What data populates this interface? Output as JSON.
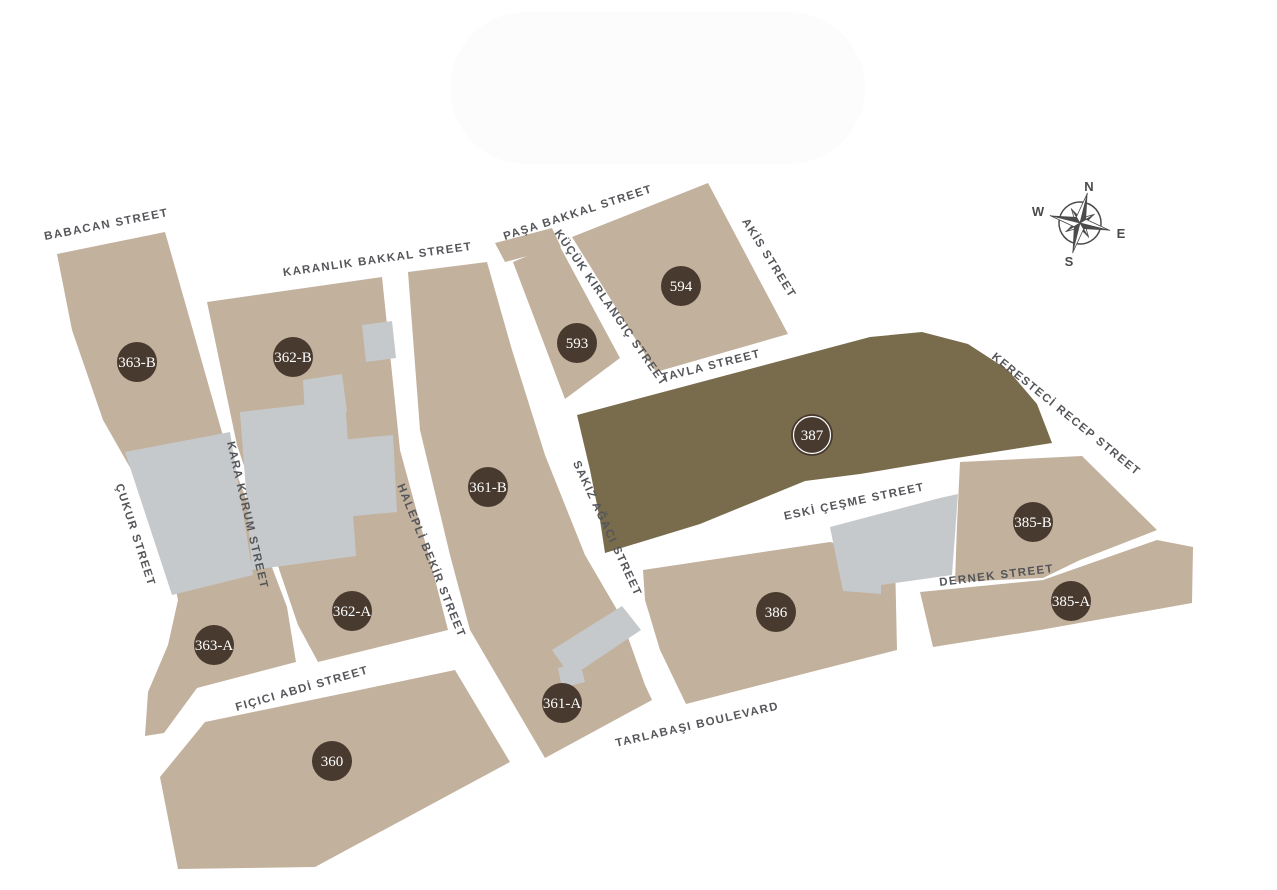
{
  "map": {
    "colors": {
      "background": "#ffffff",
      "block": "#c2b19d",
      "highlight_block": "#796c4c",
      "building": "#c6c9cb",
      "marker": "#483a2f",
      "marker_ring": "#ffffff",
      "marker_text": "#ffffff",
      "street_text": "#55565a",
      "compass": "#4b4b4b",
      "logo_blob": "#fcfcfc"
    },
    "blocks": [
      {
        "id": "363",
        "points": "57,254 165,232 225,443 287,607 296,662 197,688 164,733 145,736 148,692 168,645 178,600 168,552 140,485 103,420 72,330"
      },
      {
        "id": "362",
        "points": "207,302 382,277 400,450 430,560 448,630 318,662 298,625 237,445"
      },
      {
        "id": "361",
        "points": "408,272 487,262 512,350 545,455 585,555 620,615 645,685 652,700 545,758 470,630 450,555 420,430"
      },
      {
        "id": "593",
        "points": "513,262 558,243 620,358 565,399"
      },
      {
        "id": "594",
        "points": "572,237 708,183 788,334 656,372"
      },
      {
        "id": "387",
        "points": "577,415 870,337 922,332 968,344 1008,370 1037,404 1052,443 950,459 860,474 805,481 700,524 605,553 600,520 590,470",
        "highlight": true
      },
      {
        "id": "386",
        "points": "643,570 830,542 895,558 897,650 686,704 660,650 645,600"
      },
      {
        "id": "385B",
        "points": "960,462 1082,456 1157,530 1080,560 1043,578 955,582 957,525"
      },
      {
        "id": "385A",
        "points": "920,592 1043,580 1157,540 1193,547 1192,603 1040,630 933,647"
      },
      {
        "id": "360",
        "points": "205,722 350,692 455,670 510,762 315,867 178,869 160,777"
      },
      {
        "id": "wedge",
        "points": "495,243 552,228 561,247 505,262"
      }
    ],
    "buildings": [
      {
        "points": "125,452 230,432 253,575 172,595"
      },
      {
        "points": "303,380 342,374 347,412 305,417"
      },
      {
        "points": "240,412 345,400 356,556 252,570"
      },
      {
        "points": "340,440 393,435 397,512 344,517"
      },
      {
        "points": "362,325 392,321 396,358 366,362"
      },
      {
        "points": "552,650 622,606 641,630 571,677"
      },
      {
        "points": "558,668 580,662 585,682 562,688"
      },
      {
        "points": "830,527 940,498 958,494 952,575 881,585 881,594 843,591"
      }
    ],
    "markers": [
      {
        "label": "363-B",
        "x": 137,
        "y": 362
      },
      {
        "label": "362-B",
        "x": 293,
        "y": 357
      },
      {
        "label": "593",
        "x": 577,
        "y": 343
      },
      {
        "label": "594",
        "x": 681,
        "y": 286
      },
      {
        "label": "387",
        "x": 812,
        "y": 435,
        "ring": true,
        "r": 21
      },
      {
        "label": "361-B",
        "x": 488,
        "y": 487
      },
      {
        "label": "385-B",
        "x": 1033,
        "y": 522
      },
      {
        "label": "362-A",
        "x": 352,
        "y": 611
      },
      {
        "label": "363-A",
        "x": 214,
        "y": 645
      },
      {
        "label": "385-A",
        "x": 1071,
        "y": 601
      },
      {
        "label": "386",
        "x": 776,
        "y": 612
      },
      {
        "label": "361-A",
        "x": 562,
        "y": 703
      },
      {
        "label": "360",
        "x": 332,
        "y": 761
      }
    ],
    "streets": [
      {
        "name": "BABACAN STREET",
        "x": 107,
        "y": 228,
        "rot": -11
      },
      {
        "name": "KARANLIK BAKKAL STREET",
        "x": 378,
        "y": 263,
        "rot": -8
      },
      {
        "name": "PAŞA BAKKAL STREET",
        "x": 579,
        "y": 216,
        "rot": -18
      },
      {
        "name": "KÜÇÜK KIRLANGIÇ STREET",
        "x": 608,
        "y": 310,
        "rot": 55
      },
      {
        "name": "AKİS STREET",
        "x": 766,
        "y": 260,
        "rot": 58
      },
      {
        "name": "TAVLA STREET",
        "x": 712,
        "y": 369,
        "rot": -14
      },
      {
        "name": "KERESTECİ RECEP STREET",
        "x": 1064,
        "y": 417,
        "rot": 39
      },
      {
        "name": "ESKİ ÇEŞME STREET",
        "x": 855,
        "y": 505,
        "rot": -12
      },
      {
        "name": "DERNEK STREET",
        "x": 997,
        "y": 579,
        "rot": -7
      },
      {
        "name": "SAKIZ AĞACI STREET",
        "x": 604,
        "y": 530,
        "rot": 65
      },
      {
        "name": "HALEPLİ BEKİR STREET",
        "x": 428,
        "y": 562,
        "rot": 68
      },
      {
        "name": "KARA KURUM STREET",
        "x": 244,
        "y": 516,
        "rot": 77
      },
      {
        "name": "ÇUKUR  STREET",
        "x": 132,
        "y": 536,
        "rot": 72
      },
      {
        "name": "FIÇICI ABDİ STREET",
        "x": 303,
        "y": 692,
        "rot": -16
      },
      {
        "name": "TARLABAŞI BOULEVARD",
        "x": 698,
        "y": 728,
        "rot": -13
      }
    ],
    "compass": {
      "x": 1080,
      "y": 223,
      "rotation": 14,
      "labels": {
        "n": "N",
        "e": "E",
        "s": "S",
        "w": "W"
      },
      "label_positions": {
        "n": [
          1089,
          191
        ],
        "e": [
          1121,
          238
        ],
        "s": [
          1069,
          266
        ],
        "w": [
          1038,
          216
        ]
      }
    }
  }
}
